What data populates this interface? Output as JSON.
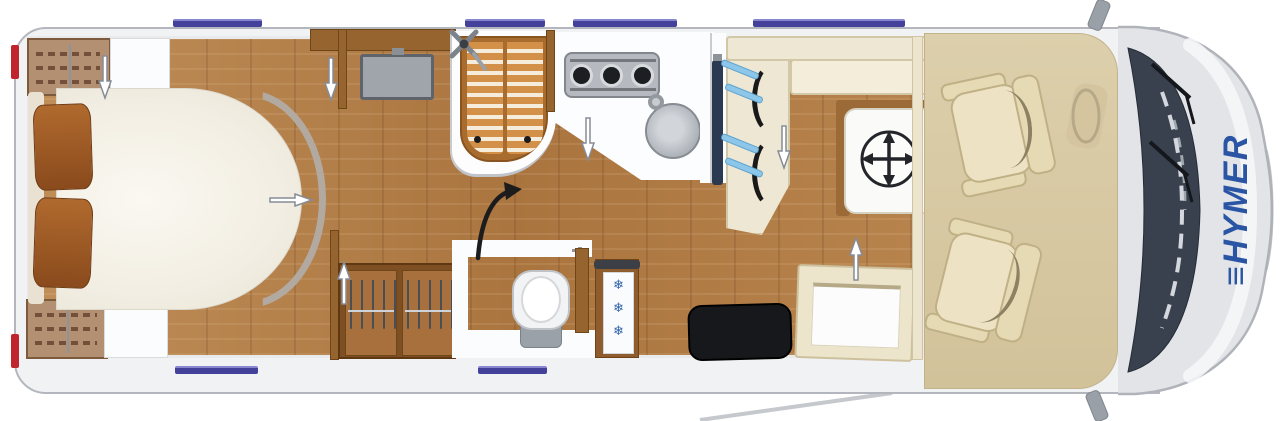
{
  "vehicle": {
    "brand": "HYMER",
    "logo_mark": "≡",
    "view": "motorhome-floorplan-top-view"
  },
  "fridge": {
    "snowflakes": "❄\n❄\n❄"
  },
  "colors": {
    "brand_blue": "#2a55a4",
    "window_blue": "#44419b",
    "seatbelt_blue": "#8cc6e9",
    "wood_floor": "#b27c45",
    "wood_furniture": "#96652f",
    "upholstery_cream": "#eee7d3",
    "cab_floor_beige": "#d8caa5",
    "windshield": "#39414f",
    "taillight_red": "#c0252e",
    "body_gray": "#f1f2f4"
  },
  "fixtures": {
    "rear_bed": "island-bed-with-pillows",
    "rear_wardrobes": "wardrobe-top / wardrobe-bottom",
    "bedroom_tv": "flatscreen-tv",
    "shower": "shower-with-wood-grate",
    "kitchen": "three-burner-stove-and-round-sink",
    "toilet": "swivel-toilet",
    "wardrobe": "double-hanging-wardrobe",
    "fridge": "refrigerator",
    "lounge": "l-shaped-dinette-with-belts-and-table",
    "lounge_tv": "wall-mounted-tv",
    "entrance": "entry-step-and-open-door",
    "cab": "two-swivel-seats-steering-wheel"
  }
}
